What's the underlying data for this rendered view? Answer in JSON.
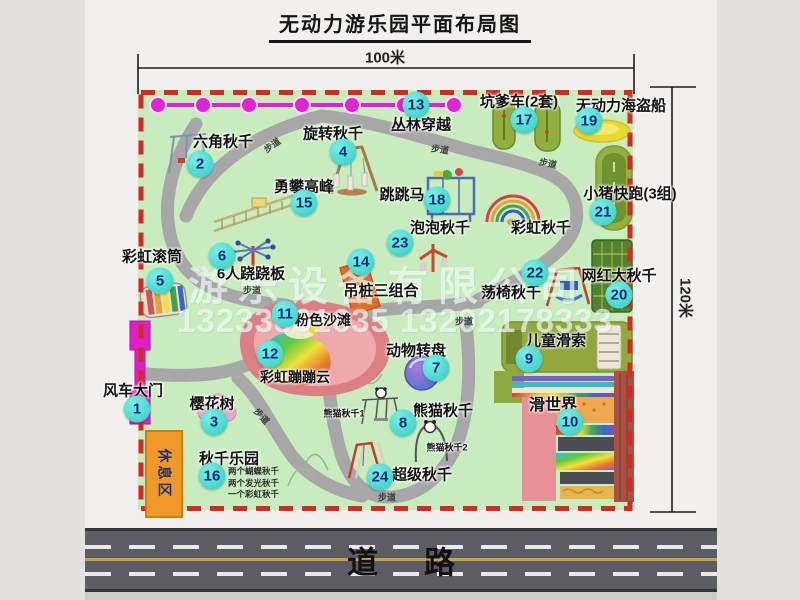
{
  "title": "无动力游乐园平面布局图",
  "dimensions": {
    "width_label": "100米",
    "height_label": "120米"
  },
  "road": {
    "label": "道路"
  },
  "watermark": {
    "company": "游乐设备有限公司",
    "phone": "13233861635 13202178333"
  },
  "walkway_label": "步道",
  "badges": [
    "1",
    "2",
    "3",
    "4",
    "5",
    "6",
    "7",
    "8",
    "9",
    "10",
    "11",
    "12",
    "13",
    "14",
    "15",
    "16",
    "17",
    "18",
    "19",
    "20",
    "21",
    "22",
    "23",
    "24"
  ],
  "labels": {
    "jungle": "丛林穿越",
    "hex_swing": "六角秋千",
    "rotary_swing": "旋转秋千",
    "climb": "勇攀高峰",
    "jump_horse": "跳跳马",
    "rainbow_swing": "彩虹秋千",
    "pit_car": "坑爹车(2套)",
    "pirate": "无动力海盗船",
    "pig_run": "小猪快跑(3组)",
    "big_swing": "网红大秋千",
    "chair_swing": "荡椅秋千",
    "pile_combo": "吊桩三组合",
    "bubble_swing": "泡泡秋千",
    "rainbow_drum": "彩虹滚筒",
    "seesaw6": "6人跷跷板",
    "pink_beach": "粉色沙滩",
    "bounce_cloud": "彩虹蹦蹦云",
    "animal_wheel": "动物转盘",
    "kid_zipline": "儿童滑索",
    "slide_world": "滑世界",
    "panda_swing": "熊猫秋千",
    "panda_swing_1": "熊猫秋千1",
    "panda_swing_2": "熊猫秋千2",
    "super_swing": "超级秋千",
    "swing_park": "秋千乐园",
    "cherry_tree": "樱花树",
    "windmill_gate": "风车大门",
    "rest_area": "休息区"
  },
  "swing_park_items": [
    "两个蝴蝶秋千",
    "两个发光秋千",
    "一个彩虹秋千"
  ],
  "colors": {
    "badge": "#3ed2cb",
    "dashed_border": "#d8291e",
    "map_green": "#c9ecbe",
    "chain_magenta": "#e11fd4",
    "gate_magenta": "#df1ec9",
    "rest_orange": "#f09828",
    "road_gray": "#5c5c64"
  }
}
